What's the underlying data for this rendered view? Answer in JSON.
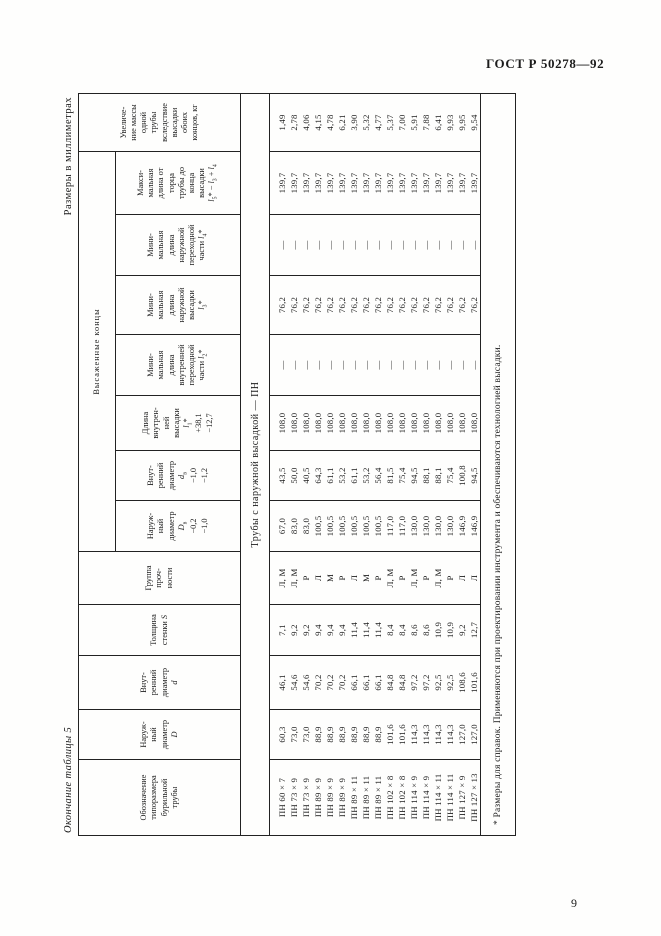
{
  "page": {
    "doc_code": "ГОСТ Р 50278—92",
    "page_number": "9",
    "table_caption_left": "Окончание таблицы 5",
    "units_caption": "Размеры  в  миллиметрах",
    "section_row_label": "Трубы с наружной высадкой — ПН",
    "footnote": "* Размеры для справок. Применяются при проектировании инструмента и обеспечиваются технологией высадки."
  },
  "table": {
    "group_header": "Высаженные концы",
    "group_header_span_start": 5,
    "group_header_span_count": 7,
    "columns": [
      {
        "id": "designation",
        "header_lines": [
          "Обозначение",
          "типоразмера",
          "бурильной",
          "трубы"
        ]
      },
      {
        "id": "outer_diameter_D",
        "header_lines": [
          "Наруж-",
          "ный",
          "диаметр",
          "<i>D</i>"
        ]
      },
      {
        "id": "inner_diameter_d",
        "header_lines": [
          "Внут-",
          "ренний",
          "диаметр",
          "<i>d</i>"
        ]
      },
      {
        "id": "wall_thickness_S",
        "header_lines": [
          "Толщина",
          "стенки <i>S</i>"
        ]
      },
      {
        "id": "strength_group",
        "header_lines": [
          "Группа",
          "проч-",
          "ности"
        ]
      },
      {
        "id": "upset_outer_diameter_Dv",
        "header_lines": [
          "Наруж-",
          "ный",
          "диаметр",
          "<i>D</i><sub>в</sub>",
          "−0,2",
          "−1,0"
        ]
      },
      {
        "id": "upset_inner_diameter_dv",
        "header_lines": [
          "Внут-",
          "ренний",
          "диаметр",
          "<i>d</i><sub>в</sub>",
          "−1,0",
          "−1,2"
        ]
      },
      {
        "id": "inner_upset_length_l1",
        "header_lines": [
          "Длина",
          "внутрен-",
          "ней",
          "высадки",
          "<i>l</i><sub>1</sub>*",
          "+38,1",
          "−12,7"
        ]
      },
      {
        "id": "min_inner_transition_l2",
        "header_lines": [
          "Мини-",
          "мальная",
          "длина",
          "внутренней",
          "переходной",
          "части <i>l</i><sub>2</sub>*"
        ]
      },
      {
        "id": "min_outer_upset_l3",
        "header_lines": [
          "Мини-",
          "мальная",
          "длина",
          "наружной",
          "высадки",
          "<i>l</i><sub>3</sub>*"
        ]
      },
      {
        "id": "min_outer_transition_l4",
        "header_lines": [
          "Мини-",
          "мальная",
          "длина",
          "наружной",
          "переходной",
          "части <i>l</i><sub>4</sub>*"
        ]
      },
      {
        "id": "max_length_l5",
        "header_lines": [
          "Макси-",
          "мальная",
          "длина от",
          "торца",
          "трубы до",
          "конца",
          "высадки",
          "<i>l</i><sub>5</sub>* − <i>l</i><sub>3</sub> + <i>l</i><sub>4</sub>"
        ]
      },
      {
        "id": "mass_increase",
        "header_lines": [
          "Увеличе-",
          "ние массы",
          "одной",
          "трубы",
          "вследствие",
          "высадки",
          "обоих",
          "концов, кг"
        ]
      }
    ],
    "rows": [
      [
        "ПН 60 × 7",
        "60,3",
        "46,1",
        "7,1",
        "Л, М",
        "67,0",
        "43,5",
        "108,0",
        "—",
        "76,2",
        "—",
        "139,7",
        "1,49"
      ],
      [
        "ПН 73 × 9",
        "73,0",
        "54,6",
        "9,2",
        "Л, М",
        "83,0",
        "50,0",
        "108,0",
        "—",
        "76,2",
        "—",
        "139,7",
        "2,78"
      ],
      [
        "ПН 73 × 9",
        "73,0",
        "54,6",
        "9,2",
        "Р",
        "83,0",
        "40,5",
        "108,0",
        "—",
        "76,2",
        "—",
        "139,7",
        "4,06"
      ],
      [
        "ПН 89 × 9",
        "88,9",
        "70,2",
        "9,4",
        "Л",
        "100,5",
        "64,3",
        "108,0",
        "—",
        "76,2",
        "—",
        "139,7",
        "4,15"
      ],
      [
        "ПН 89 × 9",
        "88,9",
        "70,2",
        "9,4",
        "М",
        "100,5",
        "61,1",
        "108,0",
        "—",
        "76,2",
        "—",
        "139,7",
        "4,78"
      ],
      [
        "ПН 89 × 9",
        "88,9",
        "70,2",
        "9,4",
        "Р",
        "100,5",
        "53,2",
        "108,0",
        "—",
        "76,2",
        "—",
        "139,7",
        "6,21"
      ],
      [
        "ПН 89 × 11",
        "88,9",
        "66,1",
        "11,4",
        "Л",
        "100,5",
        "61,1",
        "108,0",
        "—",
        "76,2",
        "—",
        "139,7",
        "3,90"
      ],
      [
        "ПН 89 × 11",
        "88,9",
        "66,1",
        "11,4",
        "М",
        "100,5",
        "53,2",
        "108,0",
        "—",
        "76,2",
        "—",
        "139,7",
        "5,32"
      ],
      [
        "ПН 89 × 11",
        "88,9",
        "66,1",
        "11,4",
        "Р",
        "100,5",
        "56,4",
        "108,0",
        "—",
        "76,2",
        "—",
        "139,7",
        "4,77"
      ],
      [
        "ПН 102 × 8",
        "101,6",
        "84,8",
        "8,4",
        "Л, М",
        "117,0",
        "81,5",
        "108,0",
        "—",
        "76,2",
        "—",
        "139,7",
        "5,37"
      ],
      [
        "ПН 102 × 8",
        "101,6",
        "84,8",
        "8,4",
        "Р",
        "117,0",
        "75,4",
        "108,0",
        "—",
        "76,2",
        "—",
        "139,7",
        "7,00"
      ],
      [
        "ПН 114 × 9",
        "114,3",
        "97,2",
        "8,6",
        "Л, М",
        "130,0",
        "94,5",
        "108,0",
        "—",
        "76,2",
        "—",
        "139,7",
        "5,91"
      ],
      [
        "ПН 114 × 9",
        "114,3",
        "97,2",
        "8,6",
        "Р",
        "130,0",
        "88,1",
        "108,0",
        "—",
        "76,2",
        "—",
        "139,7",
        "7,88"
      ],
      [
        "ПН 114 × 11",
        "114,3",
        "92,5",
        "10,9",
        "Л, М",
        "130,0",
        "88,1",
        "108,0",
        "—",
        "76,2",
        "—",
        "139,7",
        "6,41"
      ],
      [
        "ПН 114 × 11",
        "114,3",
        "92,5",
        "10,9",
        "Р",
        "130,0",
        "75,4",
        "108,0",
        "—",
        "76,2",
        "—",
        "139,7",
        "9,93"
      ],
      [
        "ПН 127 × 9",
        "127,0",
        "108,6",
        "9,2",
        "Л",
        "146,9",
        "100,8",
        "108,0",
        "—",
        "76,2",
        "—",
        "139,7",
        "9,95"
      ],
      [
        "ПН 127 × 13",
        "127,0",
        "101,6",
        "12,7",
        "Л",
        "146,9",
        "94,5",
        "108,0",
        "—",
        "76,2",
        "—",
        "139,7",
        "9,54"
      ]
    ]
  }
}
